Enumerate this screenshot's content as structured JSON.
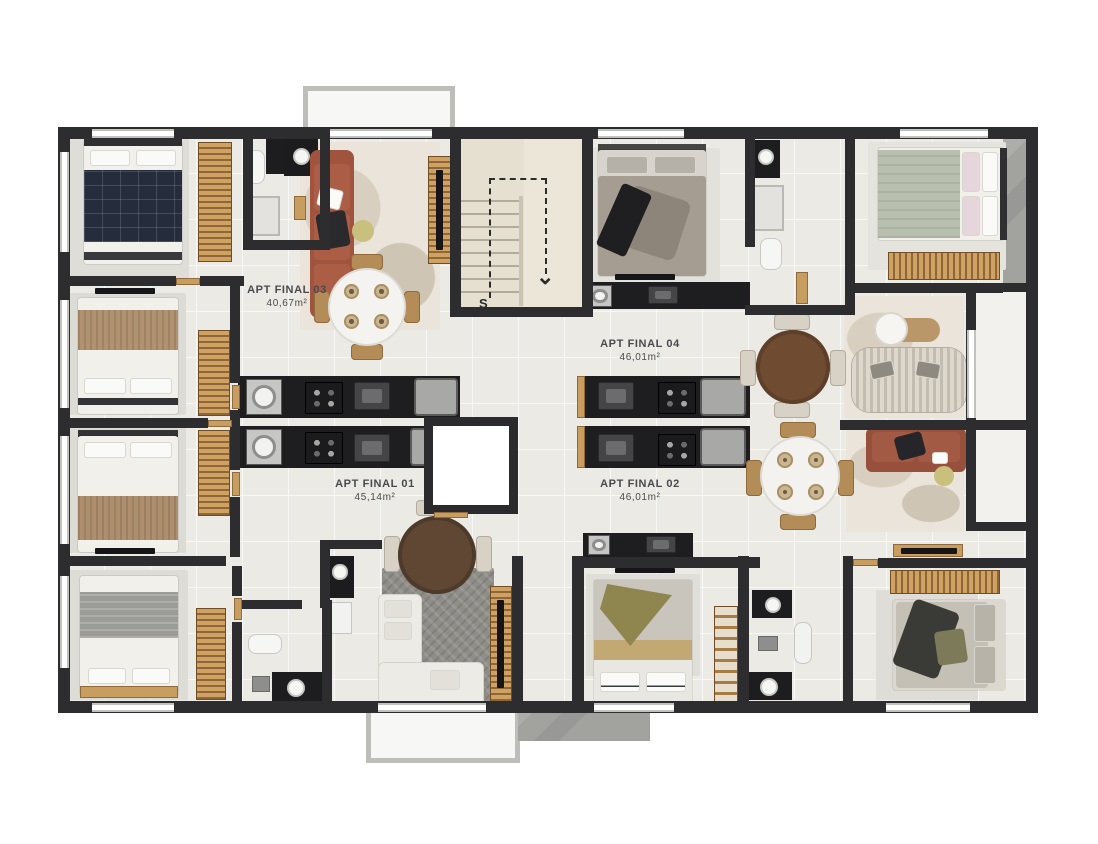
{
  "floor_plan": {
    "apartments": [
      {
        "name": "APT FINAL 03",
        "area": "40,67m²"
      },
      {
        "name": "APT FINAL 04",
        "area": "46,01m²"
      },
      {
        "name": "APT FINAL 01",
        "area": "45,14m²"
      },
      {
        "name": "APT FINAL 02",
        "area": "46,01m²"
      }
    ],
    "staircase": {
      "label": "S",
      "direction_arrow": "⌄"
    },
    "colors": {
      "wall": "#2d2d2f",
      "floor": "#ebeae5",
      "stair_floor": "#e6e0d1",
      "wood": "#c79e60",
      "terracotta_sofa": "#a0543e",
      "rust_sofa": "#96503c",
      "cream_sofa": "#d5d0c3",
      "navy_bed": "#252c3c",
      "sage_bed": "#b9bfae",
      "olive_accent": "#8f854f",
      "concrete": "#a2a29f"
    }
  }
}
